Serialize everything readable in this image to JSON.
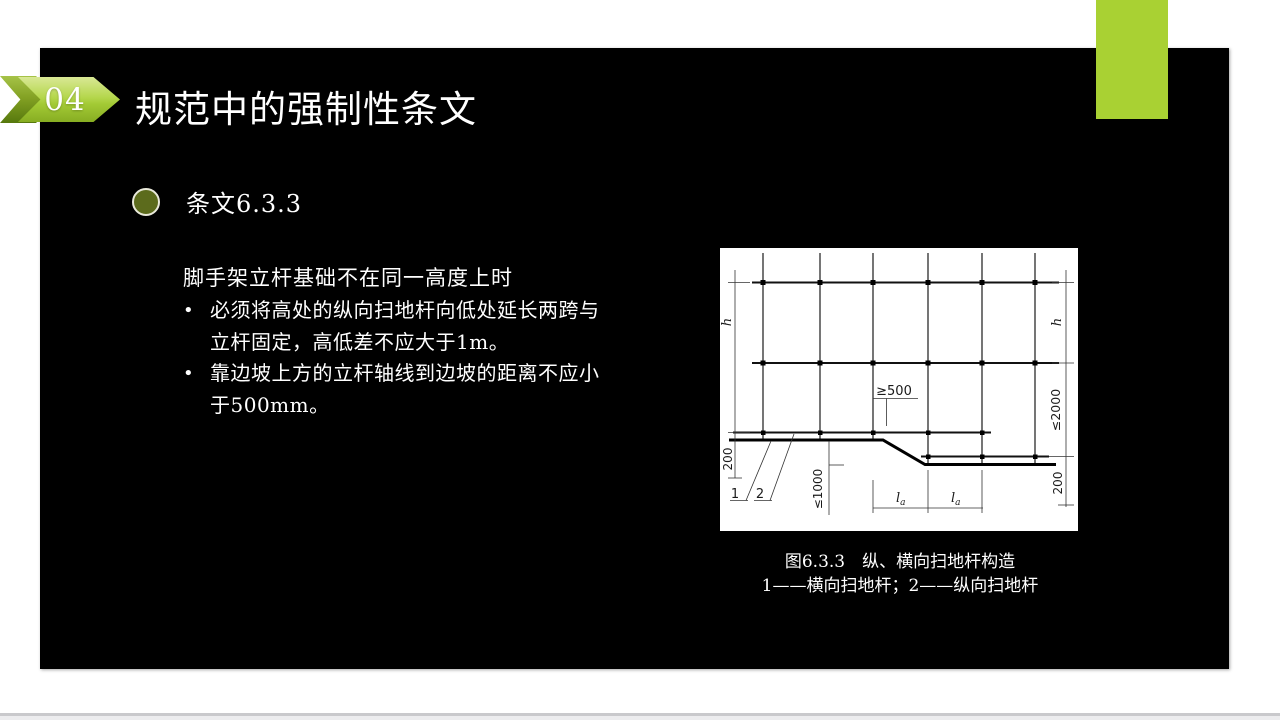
{
  "slide": {
    "page_number": "04",
    "title": "规范中的强制性条文",
    "section": {
      "heading": "条文6.3.3"
    },
    "body": {
      "intro": "脚手架立杆基础不在同一高度上时",
      "bullet_char": "•",
      "bullets": [
        {
          "line1": "必须将高处的纵向扫地杆向低处延长两跨与",
          "line2": "立杆固定，高低差不应大于1m。"
        },
        {
          "line1": "靠边坡上方的立杆轴线到边坡的距离不应小",
          "line2": "于500mm。"
        }
      ]
    }
  },
  "figure": {
    "caption_line1": "图6.3.3　纵、横向扫地杆构造",
    "caption_line2": "1——横向扫地杆；2——纵向扫地杆",
    "labels": {
      "h": "h",
      "ge500": "≥500",
      "le2000": "≤2000",
      "two_hundred": "200",
      "le1000": "≤1000",
      "l_main": "l",
      "l_sub": "a",
      "one": "1",
      "two": "2"
    }
  },
  "colors": {
    "accent_green": "#a9d133",
    "bullet_olive": "#5c6b1c",
    "slide_bg": "#000000"
  }
}
